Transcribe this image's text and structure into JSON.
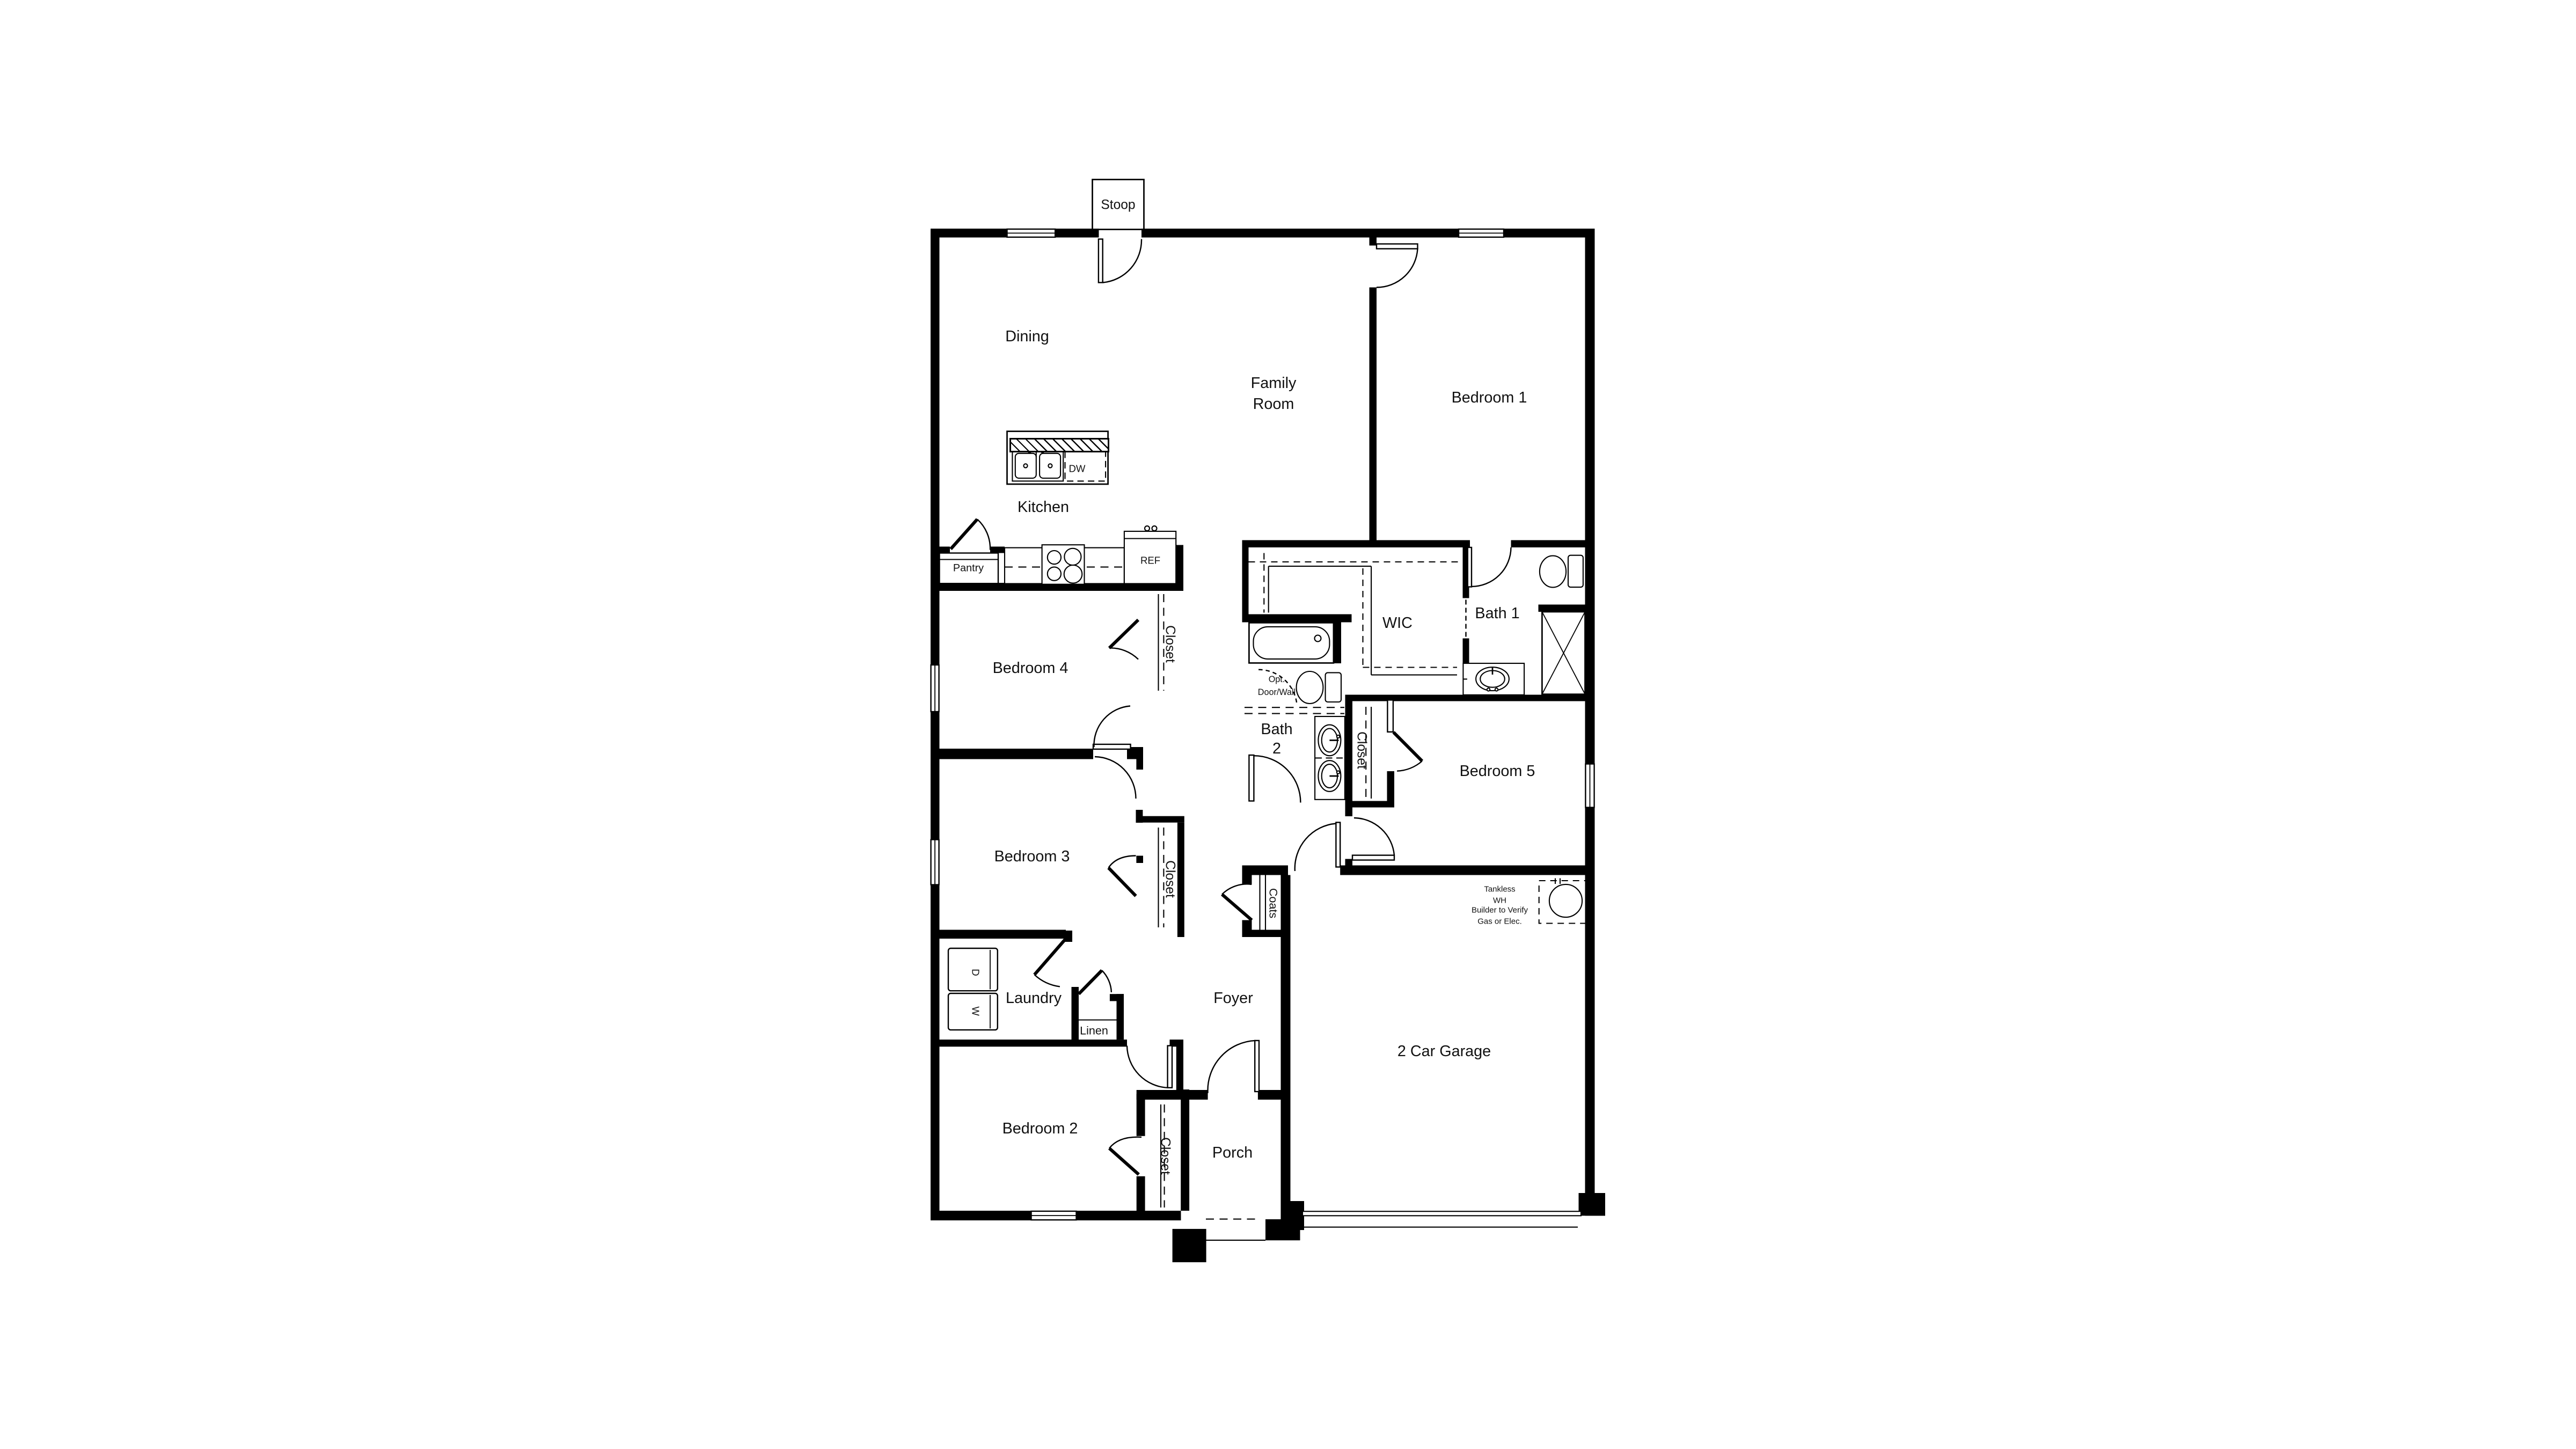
{
  "floor_plan": {
    "rooms": {
      "stoop": "Stoop",
      "dining": "Dining",
      "family_line1": "Family",
      "family_line2": "Room",
      "bedroom1": "Bedroom 1",
      "kitchen": "Kitchen",
      "bedroom4": "Bedroom 4",
      "wic": "WIC",
      "bath1": "Bath 1",
      "bath2_line1": "Bath",
      "bath2_line2": "2",
      "bedroom5": "Bedroom 5",
      "bedroom3": "Bedroom 3",
      "laundry": "Laundry",
      "foyer": "Foyer",
      "bedroom2": "Bedroom 2",
      "porch": "Porch",
      "garage": "2 Car Garage"
    },
    "closets": {
      "closet_label": "Closet",
      "coats": "Coats",
      "linen": "Linen",
      "pantry": "Pantry"
    },
    "fixtures": {
      "ref": "REF",
      "dw": "DW",
      "washer": "W",
      "dryer": "D"
    },
    "annotations": {
      "opt_line1": "Opt.",
      "opt_line2": "Door/Wall",
      "tankless_line1": "Tankless",
      "tankless_line2": "WH",
      "tankless_line3": "Builder to Verify",
      "tankless_line4": "Gas or Elec."
    },
    "colors": {
      "wall": "#000000",
      "background": "#ffffff"
    }
  }
}
